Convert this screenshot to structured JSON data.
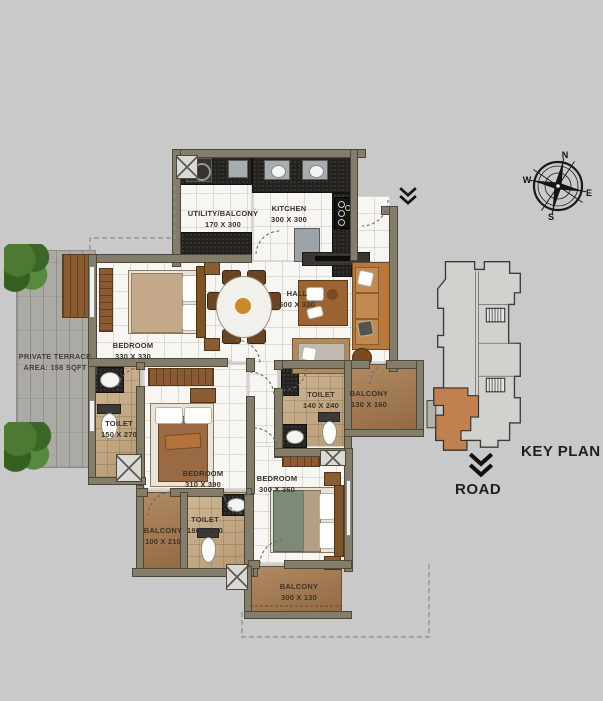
{
  "plan_title": "3BHK apartment floor plan",
  "palette": {
    "background": "#c9c9c9",
    "wall": "#857d6c",
    "floor_tile": "#f7f6f3",
    "toilet_tile": "#c7ac84",
    "balcony": "#a87c50",
    "terrace": "#abaaa5",
    "counter_dark": "#24221e",
    "keyplan_unit": "#c0804f"
  },
  "rooms": {
    "utility": {
      "name": "UTILITY/BALCONY",
      "dims": "170 X 300"
    },
    "kitchen": {
      "name": "KITCHEN",
      "dims": "300 X 300"
    },
    "hall": {
      "name": "HALL",
      "dims": "600 X 330"
    },
    "bedroom_master": {
      "name": "BEDROOM",
      "dims": "330 X 330"
    },
    "terrace": {
      "name": "PRIVATE TERRACE",
      "dims": "AREA: 158 SQFT"
    },
    "toilet_master": {
      "name": "TOILET",
      "dims": "150 X 270"
    },
    "bedroom_middle": {
      "name": "BEDROOM",
      "dims": "310 X 390"
    },
    "toilet_common": {
      "name": "TOILET",
      "dims": "140 X 240"
    },
    "balcony_east": {
      "name": "BALCONY",
      "dims": "130 X 160"
    },
    "bedroom_south": {
      "name": "BEDROOM",
      "dims": "300 X 360"
    },
    "balcony_west": {
      "name": "BALCONY",
      "dims": "100 X 210"
    },
    "toilet_south": {
      "name": "TOILET",
      "dims": "180 X 210"
    },
    "balcony_south": {
      "name": "BALCONY",
      "dims": "300 X 130"
    }
  },
  "compass": {
    "n": "N",
    "e": "E",
    "s": "S",
    "w": "W"
  },
  "keyplan": {
    "title": "KEY PLAN",
    "road": "ROAD"
  }
}
